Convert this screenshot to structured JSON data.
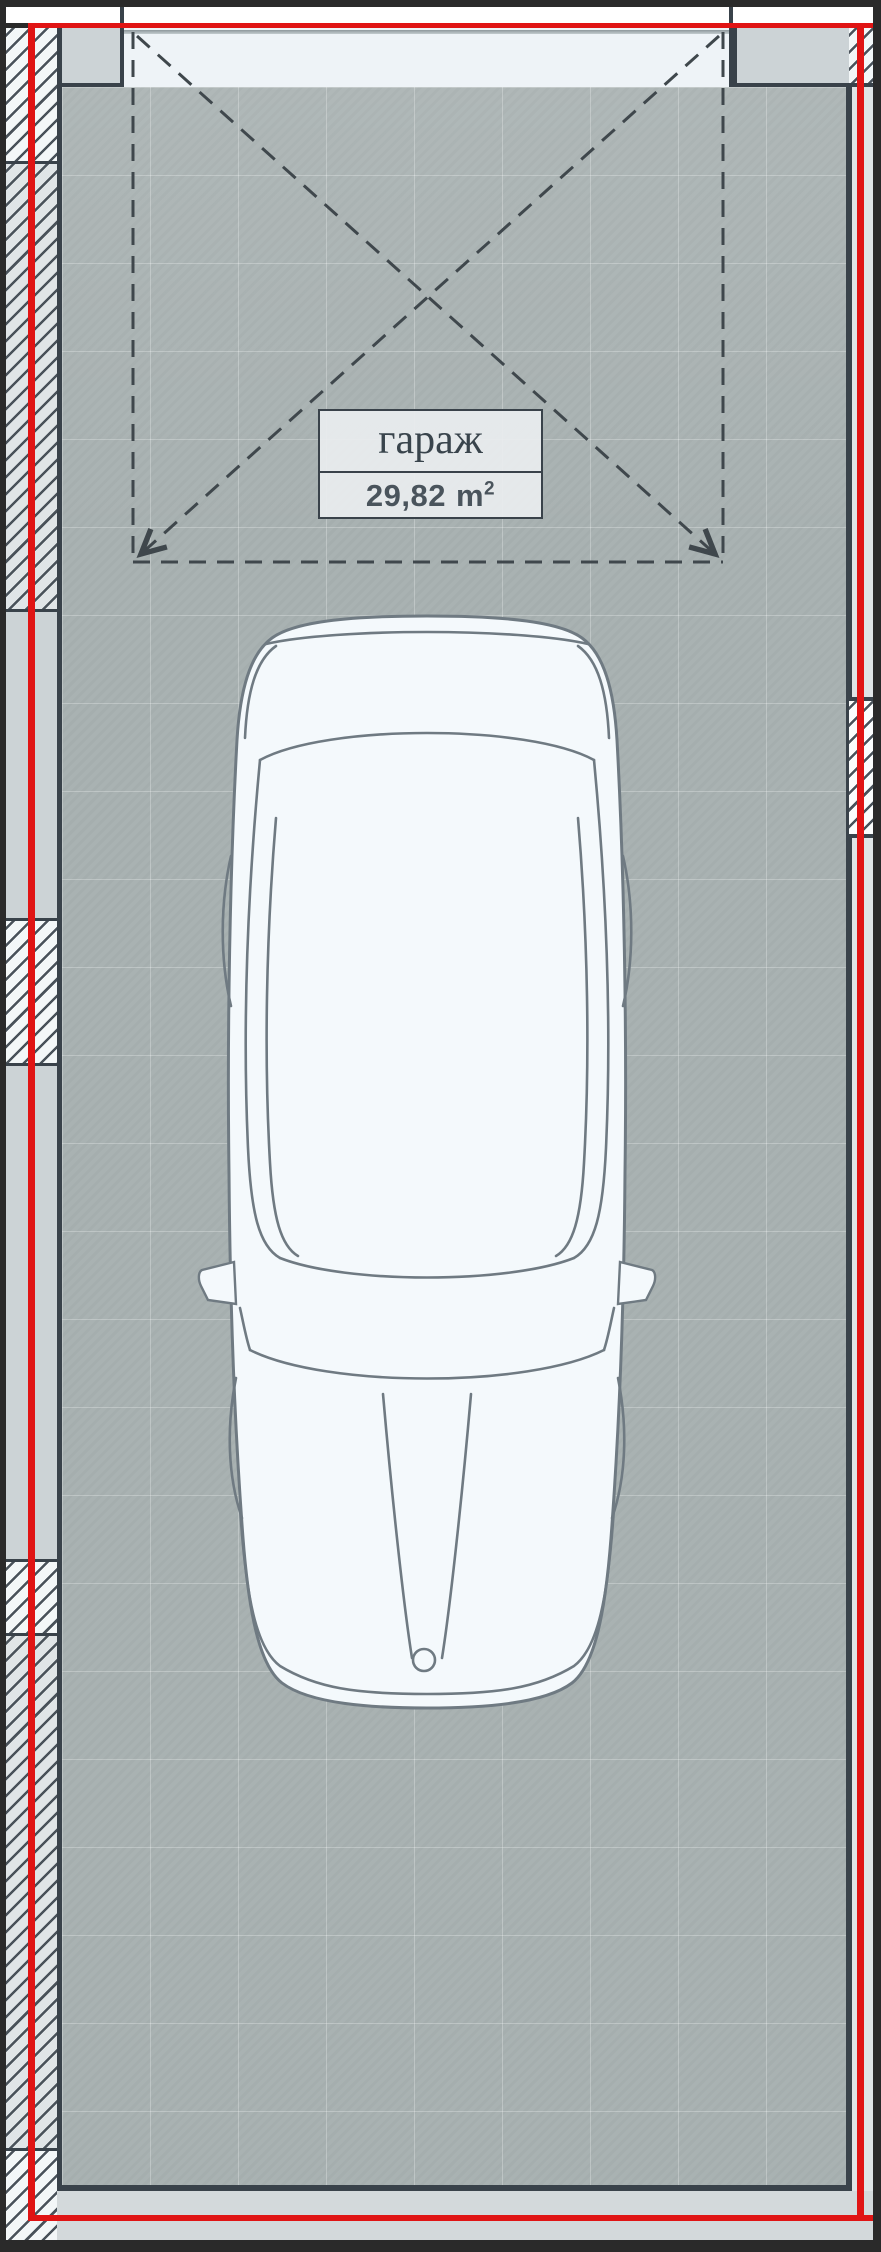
{
  "room": {
    "name": "гараж",
    "area_value": "29,82",
    "area_unit_base": "m",
    "area_unit_sup": "2"
  },
  "colors": {
    "accent_red": "#e01414",
    "floor": "#a9b2b2",
    "wall_line": "#39424a",
    "wall_fill": "#ccd3d6",
    "hatch_background_light": "#f3f7f8",
    "hatch_background_gray": "#e0e5e7",
    "threshold": "#eef3f7",
    "car_fill": "#f4f9fc",
    "car_stroke": "#6f7a82",
    "frame": "#2a2a2a"
  }
}
